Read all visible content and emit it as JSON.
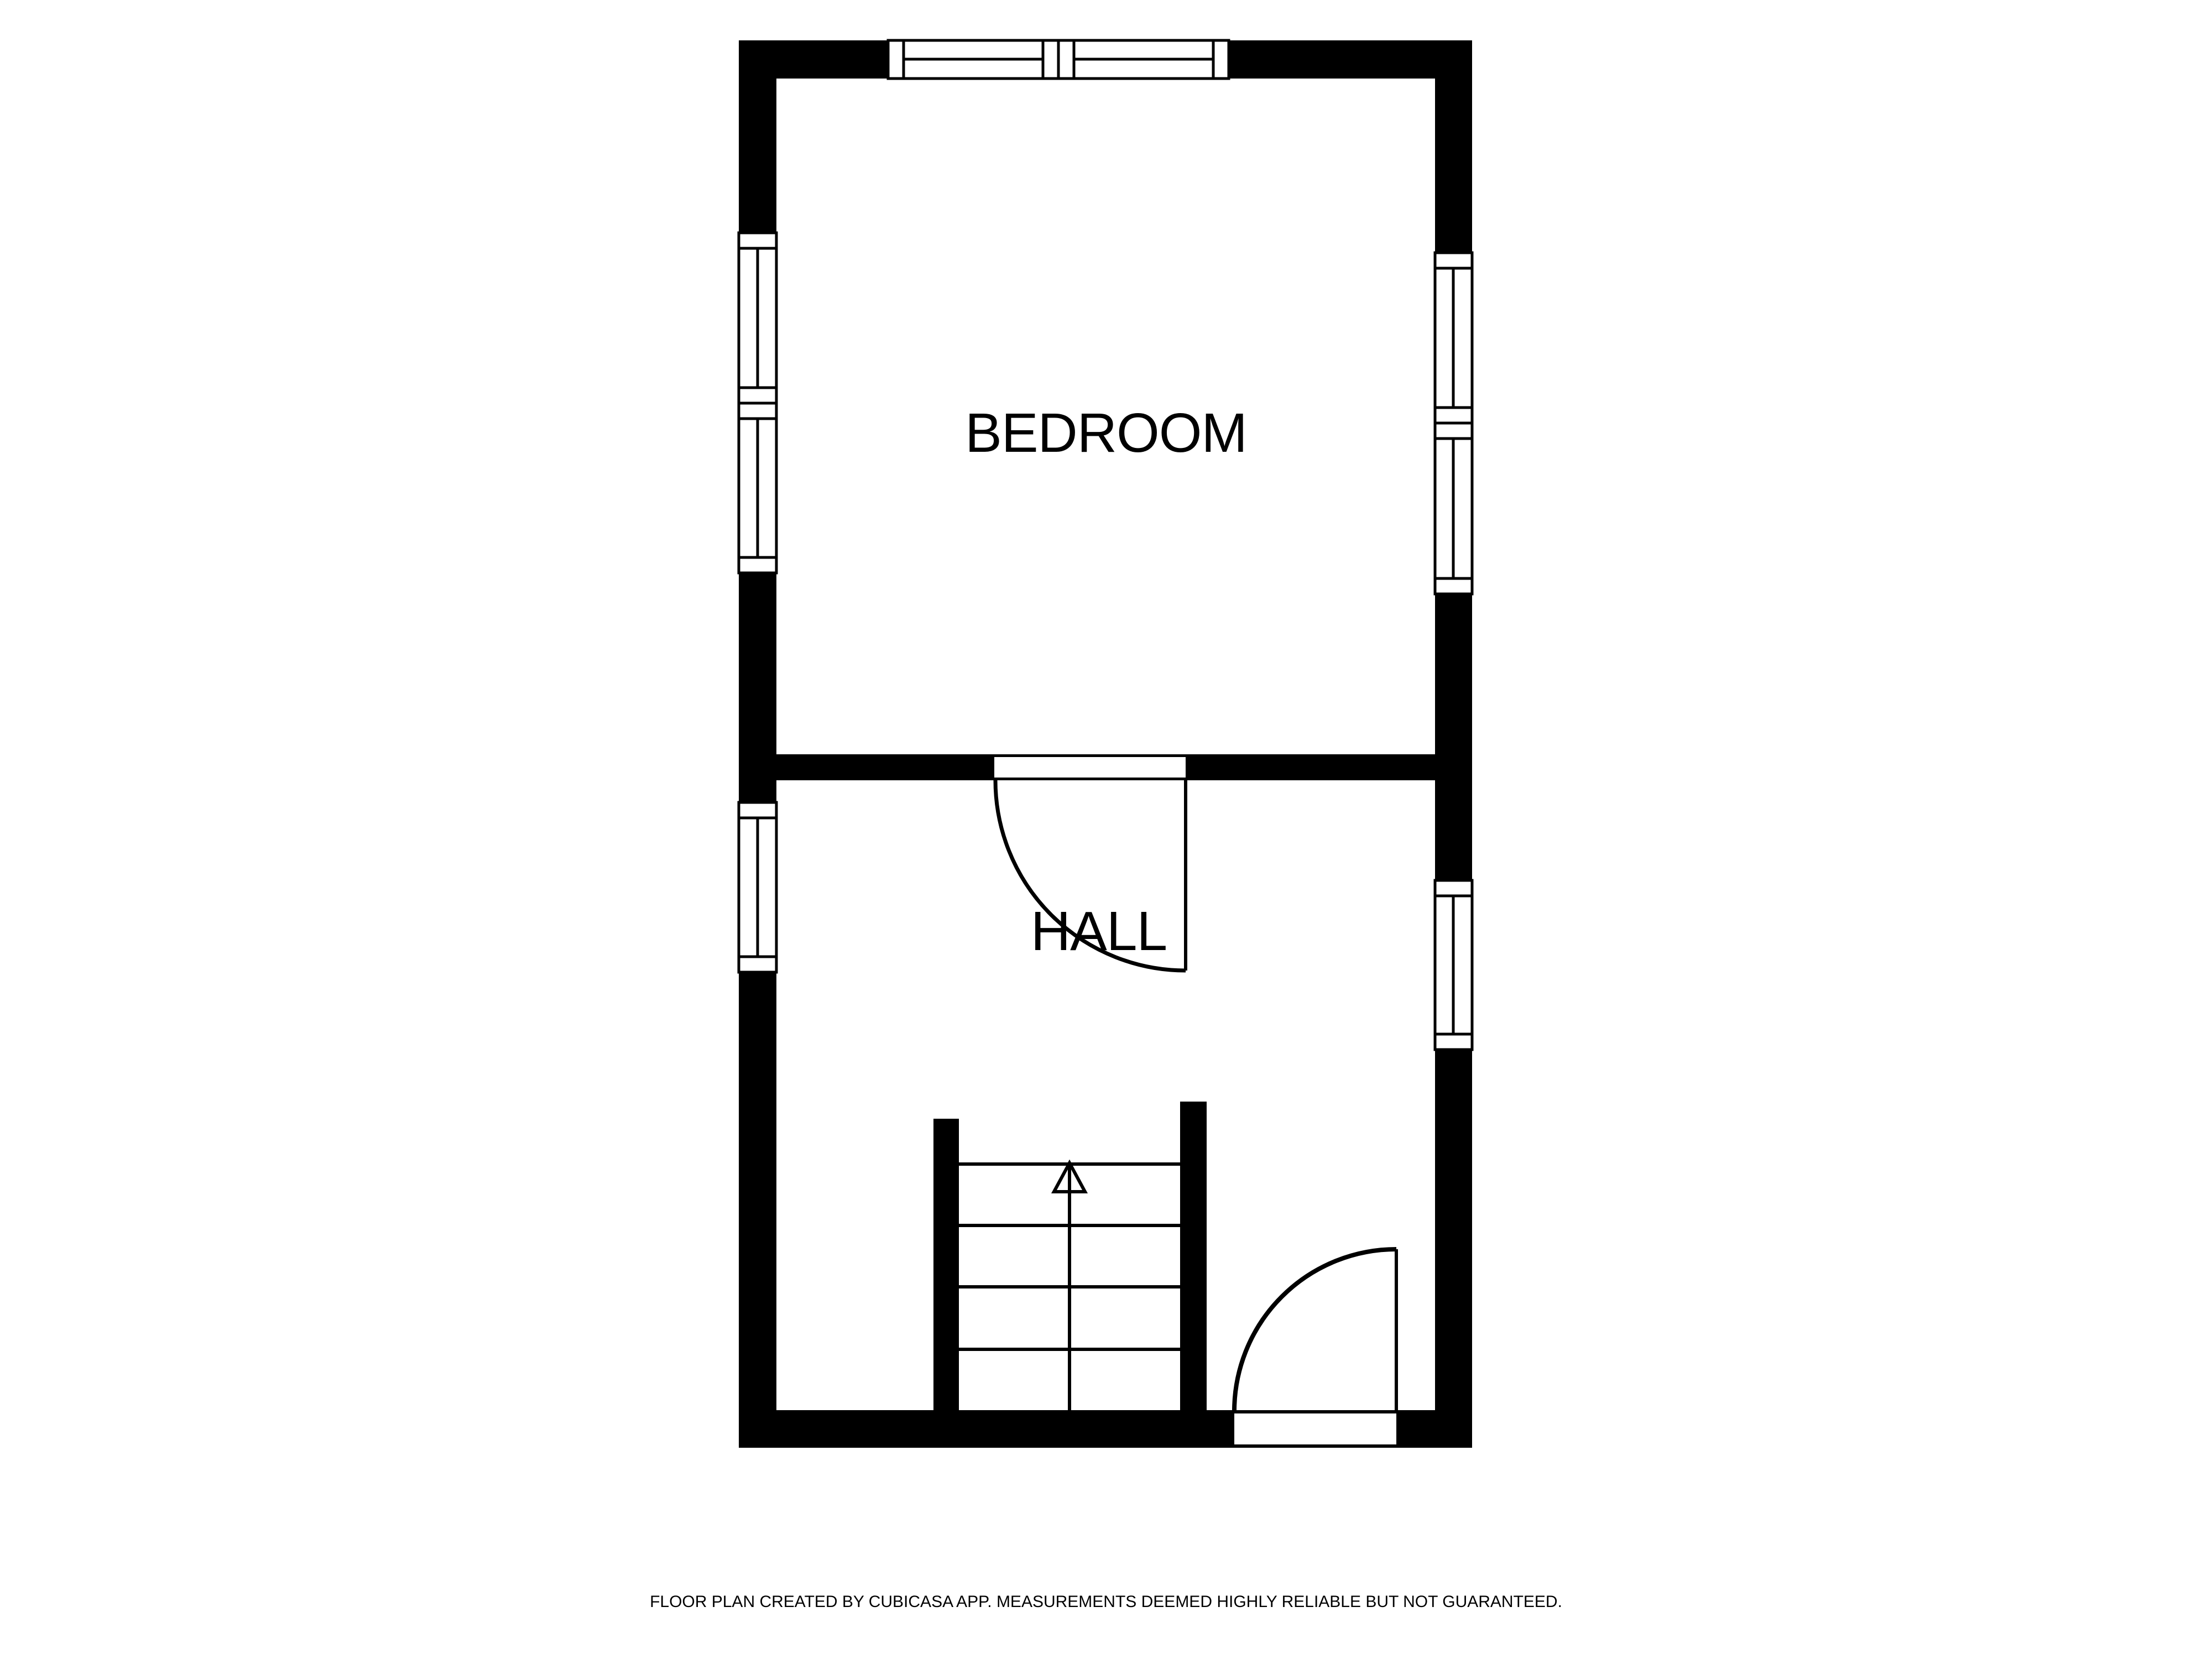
{
  "floor_plan": {
    "rooms": [
      {
        "label": "BEDROOM"
      },
      {
        "label": "HALL"
      }
    ],
    "features": {
      "windows_count": 8,
      "doors_count": 2,
      "staircase": "stairs-up-arrow"
    },
    "footer": "FLOOR PLAN CREATED BY CUBICASA APP. MEASUREMENTS DEEMED HIGHLY RELIABLE BUT NOT GUARANTEED.",
    "colors": {
      "wall": "#000000",
      "background": "#ffffff",
      "line": "#000000"
    }
  }
}
